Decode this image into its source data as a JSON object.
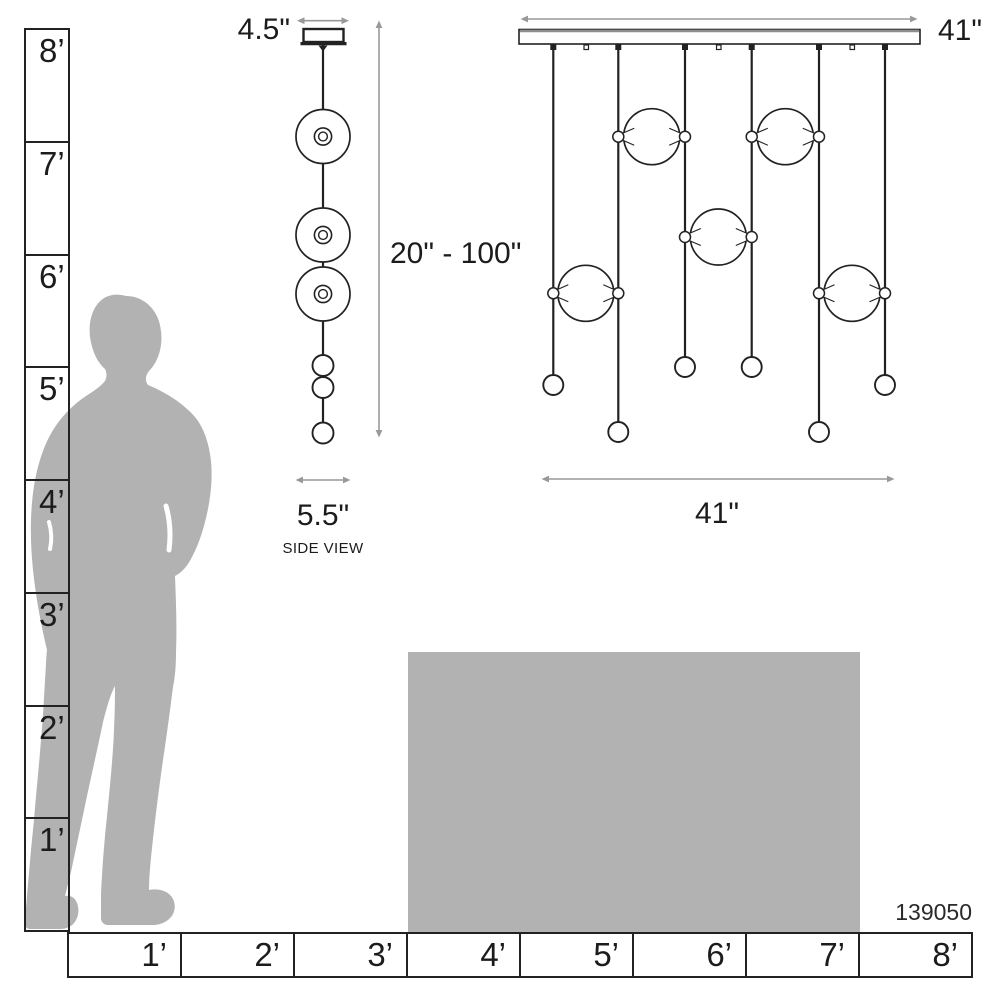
{
  "product": {
    "model_number": "139050"
  },
  "vertical_ruler": {
    "unit_labels": [
      "8’",
      "7’",
      "6’",
      "5’",
      "4’",
      "3’",
      "2’",
      "1’"
    ]
  },
  "horizontal_ruler": {
    "unit_labels": [
      "1’",
      "2’",
      "3’",
      "4’",
      "5’",
      "6’",
      "7’",
      "8’"
    ]
  },
  "side_view": {
    "caption": "SIDE VIEW",
    "canopy_width": "4.5\"",
    "suspension_height_range": "20\" - 100\"",
    "fixture_width": "5.5\""
  },
  "front_view": {
    "canopy_width": "41\"",
    "fixture_width": "41\""
  },
  "colors": {
    "silhouette_gray": "#b2b2b2",
    "table_gray": "#b2b2b2",
    "line_black": "#222222",
    "dimension_gray": "#999999"
  }
}
